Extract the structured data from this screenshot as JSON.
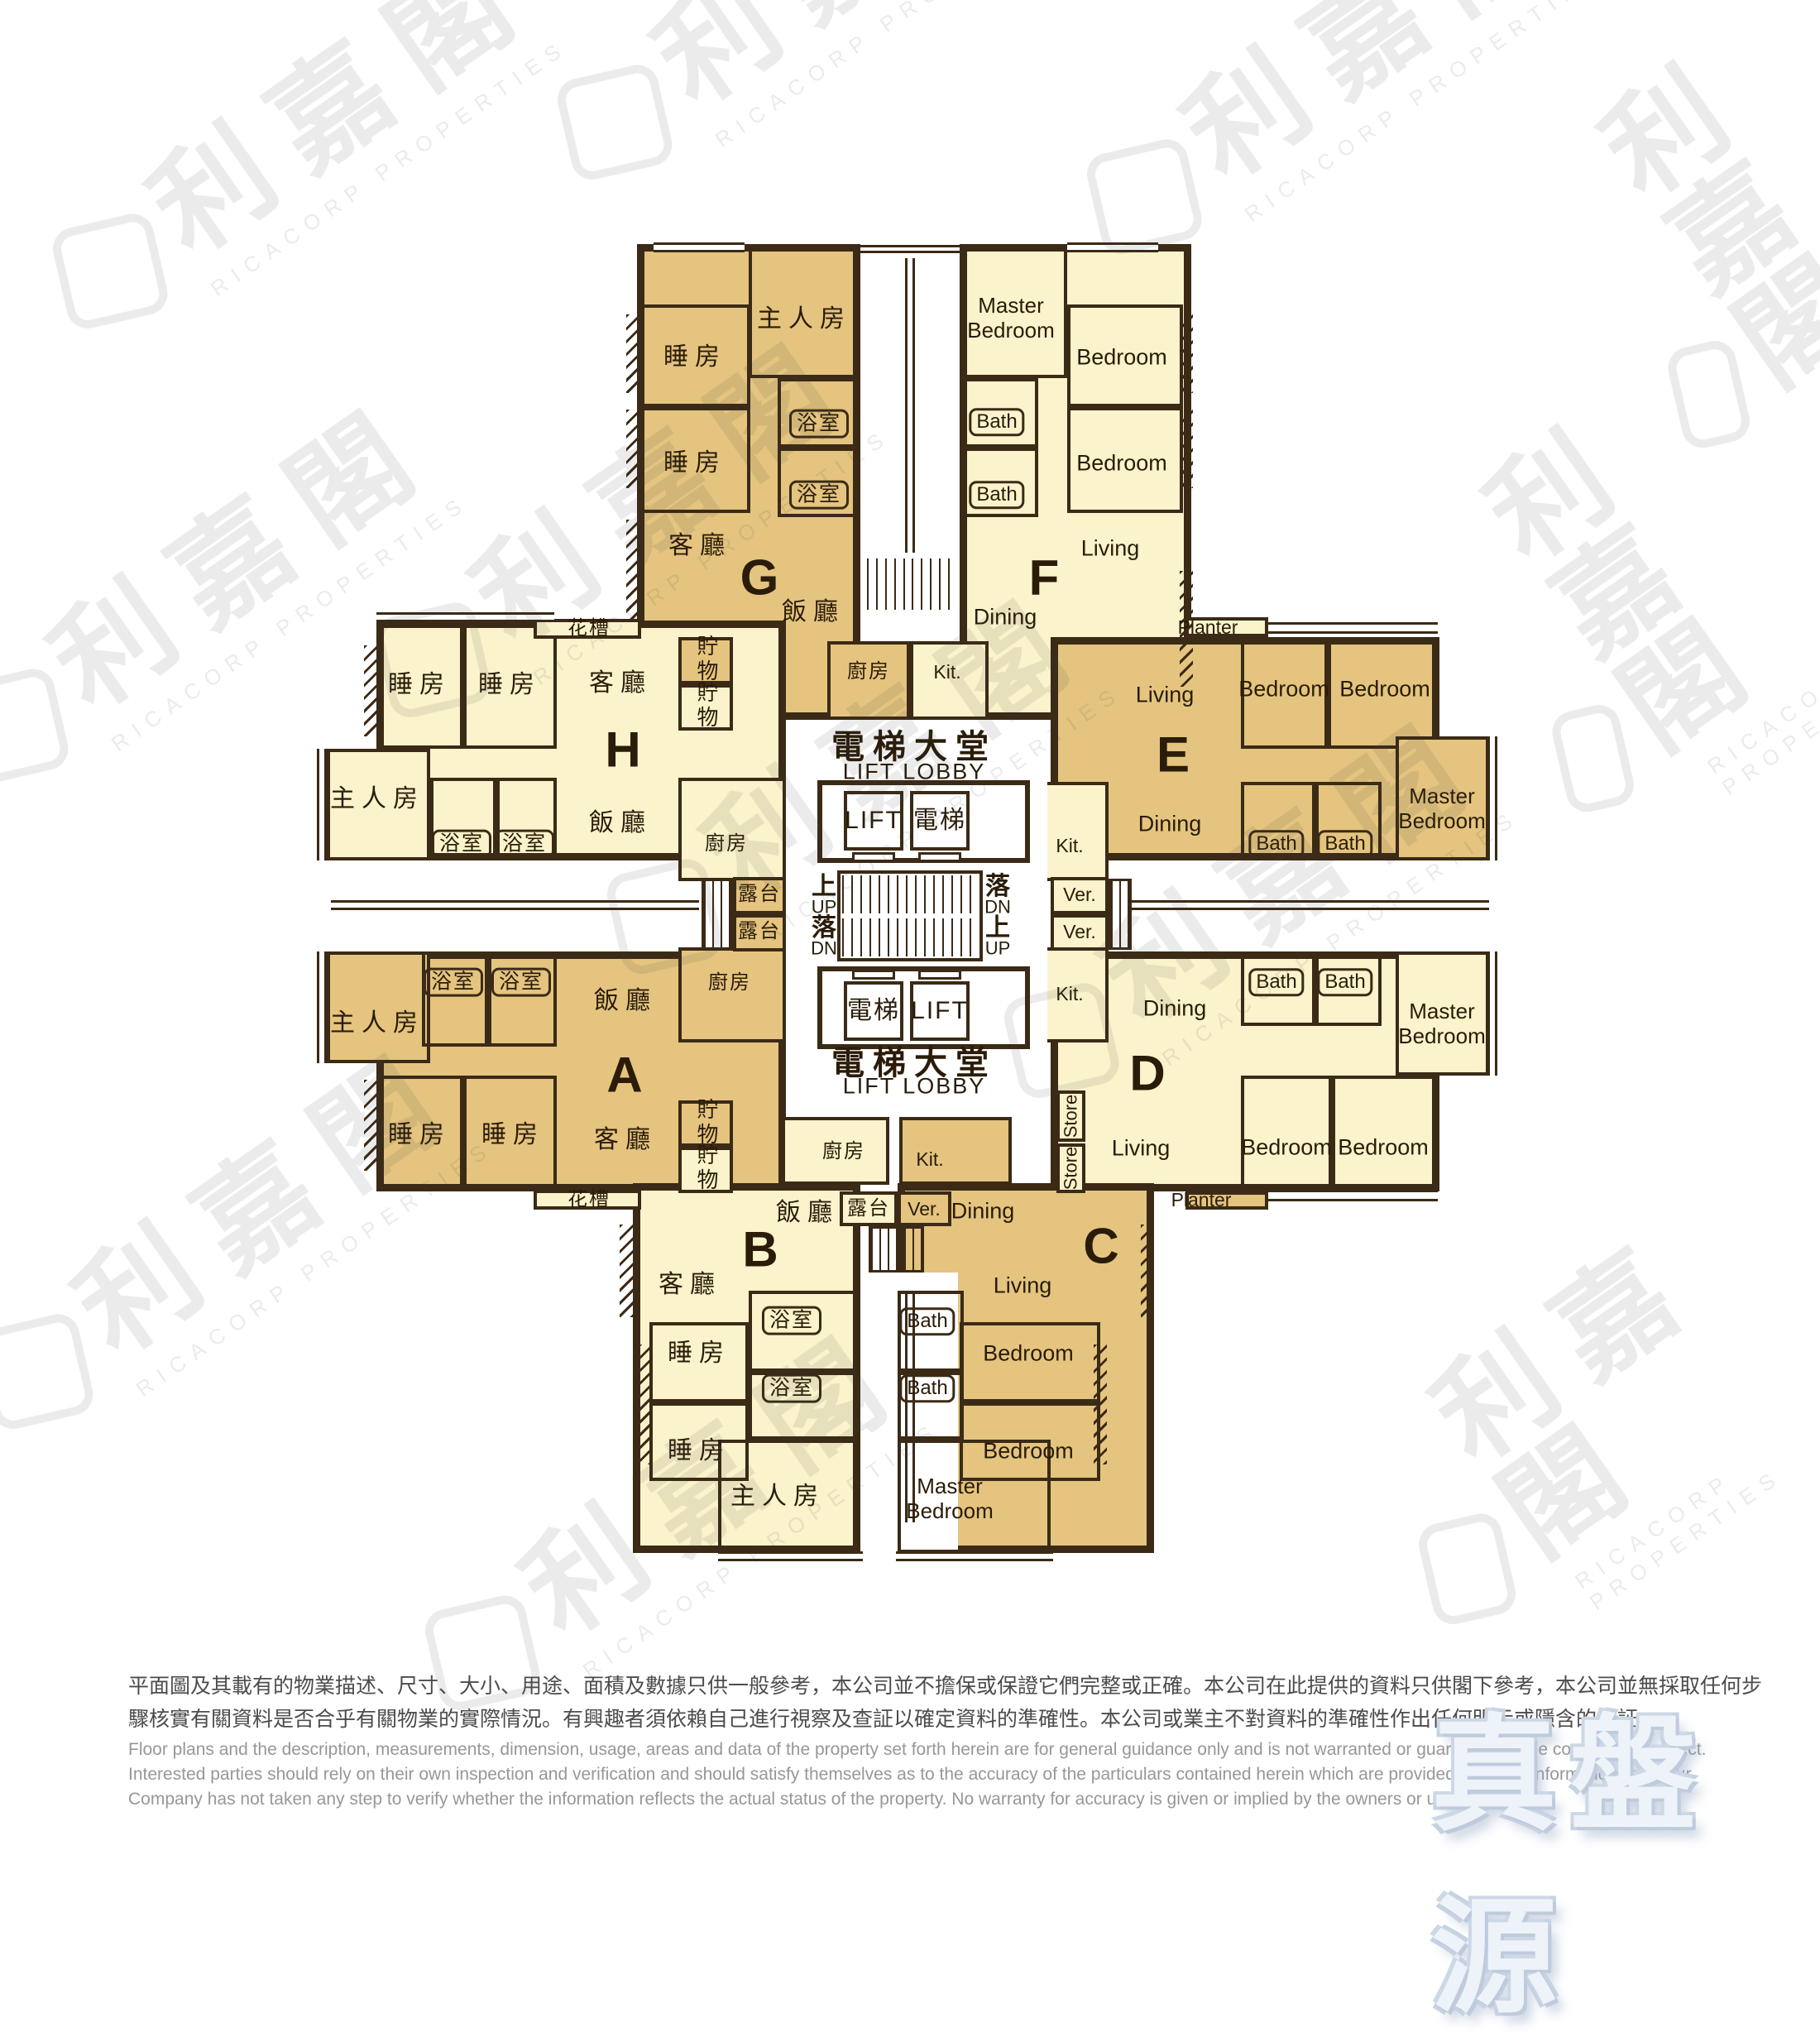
{
  "branding": {
    "watermark_cjk": "利嘉閣",
    "watermark_en": "RICACORP PROPERTIES",
    "true_listing": "真盤源"
  },
  "core": {
    "lobby_cjk": "電梯大堂",
    "lobby_en": "LIFT LOBBY",
    "lift_en": "LIFT",
    "lift_cjk": "電梯",
    "up_cjk": "上",
    "up_en": "UP",
    "down_cjk": "落",
    "down_en": "DN"
  },
  "units": {
    "A": {
      "letter": "A",
      "master": "主人房",
      "bedroom": "睡房",
      "bath": "浴室",
      "living": "客廳",
      "dining": "飯廳",
      "kitchen": "廚房",
      "store": "貯物",
      "planter": "花槽",
      "balcony": "露台"
    },
    "B": {
      "letter": "B",
      "master": "主人房",
      "bedroom": "睡房",
      "bath": "浴室",
      "living": "客廳",
      "dining": "飯廳",
      "kitchen": "廚房",
      "store": "貯物",
      "balcony": "露台"
    },
    "C": {
      "letter": "C",
      "master": "Master Bedroom",
      "bedroom": "Bedroom",
      "bath": "Bath",
      "living": "Living",
      "dining": "Dining",
      "kitchen": "Kit.",
      "veranda": "Ver."
    },
    "D": {
      "letter": "D",
      "master": "Master Bedroom",
      "bedroom": "Bedroom",
      "bath": "Bath",
      "living": "Living",
      "dining": "Dining",
      "kitchen": "Kit.",
      "store": "Store",
      "veranda": "Ver.",
      "planter": "Planter"
    },
    "E": {
      "letter": "E",
      "master": "Master Bedroom",
      "bedroom": "Bedroom",
      "bath": "Bath",
      "living": "Living",
      "dining": "Dining",
      "kitchen": "Kit.",
      "veranda": "Ver.",
      "planter": "Planter"
    },
    "F": {
      "letter": "F",
      "master": "Master Bedroom",
      "bedroom": "Bedroom",
      "bath": "Bath",
      "living": "Living",
      "dining": "Dining",
      "kitchen": "Kit."
    },
    "G": {
      "letter": "G",
      "master": "主人房",
      "bedroom": "睡房",
      "bath": "浴室",
      "living": "客廳",
      "dining": "飯廳",
      "kitchen": "廚房",
      "store": "貯物",
      "planter": "花槽"
    },
    "H": {
      "letter": "H",
      "master": "主人房",
      "bedroom": "睡房",
      "bath": "浴室",
      "living": "客廳",
      "dining": "飯廳",
      "kitchen": "廚房",
      "store": "貯物"
    }
  },
  "colors": {
    "unit_gold": "#e4c47f",
    "unit_cream": "#faf3cb",
    "wall": "#3b2a16",
    "true_listing_blue": "#c6d2e2"
  },
  "disclaimer": {
    "zh1": "平面圖及其載有的物業描述、尺寸、大小、用途、面積及數據只供一般參考，本公司並不擔保或保證它們完整或正確。本公司在此提供的資料只供閣下參考，本公司並無採取任何步",
    "zh2": "驟核實有關資料是否合乎有關物業的實際情況。有興趣者須依賴自己進行視察及查証以確定資料的準確性。本公司或業主不對資料的準確性作出任何明示或隱含的保証。",
    "en1": "Floor plans and the description, measurements, dimension, usage, areas and data of the property set forth herein are for general guidance only and is not warranted or guaranteed to be complete or correct.",
    "en2": "Interested parties should rely on their own inspection and verification and should satisfy themselves as to the accuracy of the particulars contained herein which are provided by us for information only.  Our",
    "en3": "Company has not taken any step to verify whether the information reflects the actual status of the property.  No warranty for accuracy is given or implied by the owners or us."
  }
}
